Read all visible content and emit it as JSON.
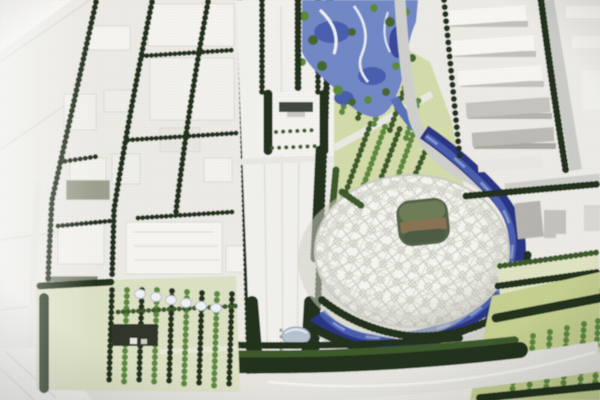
{
  "scene": {
    "kind": "photograph",
    "subject": "Aerial photo of an architectural scale model of an Olympic park district",
    "notable_features": [
      "white lattice-shell oval stadium (bird's-nest style) with rounded roof opening showing green field and brown stands",
      "dark blue crescent canal wrapping the stadium's south and east sides",
      "winding light-blue river through a wooded water park at top center",
      "broad white north-south central axis boulevard lined with dark tree rows and a small dark-roofed gate",
      "grid of white city blocks with tree-lined streets on the left half",
      "rows of white slab buildings with a diagonal road in the upper right",
      "dense dark evergreen grove with small white dome structures at lower left",
      "yellow-green lawns with regular tree rows along the bottom and lower right",
      "grey ring road sweeping from top center around the stadium"
    ]
  },
  "palette": {
    "ground_base": "#ebeae5",
    "road_light": "#f1f0ec",
    "road_grey": "#cfd0cc",
    "block_white": "#f6f5f1",
    "block_side": "#cfcec8",
    "block_grey": "#b4b3ad",
    "block_olive": "#9ca08d",
    "tree_dark": "#24331b",
    "tree_mid": "#3d5a2a",
    "tree_bright": "#5c8a3c",
    "park_ground": "#d2dba9",
    "lawn_yellow_green": "#c4cf90",
    "grove_ground": "#dce1c4",
    "water_light": "#7288c6",
    "water_mid": "#4a5fae",
    "water_dark": "#2c3684",
    "stadium_shell": "#f5f5f0",
    "stadium_lattice": "#c8c8c0",
    "stadium_field": "#6e7d57",
    "stadium_stand": "#8a7352",
    "gate_roof": "#40463f",
    "dome_blue_grey": "#b7c2cf"
  },
  "regions": {
    "west": "low-contrast white parcels and blocks with tilted tree-lined streets",
    "center": "central axis boulevard running full height",
    "top_center": "water park with winding river and bright tree clusters",
    "center_right": "lattice stadium ringed by canal, trees and grey road",
    "top_right": "slab housing rows beside a diagonal tree-lined road",
    "bottom": "dense dark tree band over a curving light road",
    "bottom_left": "formal grove with white dome structures and a dark pavilion",
    "bottom_right": "lawn with evenly spaced bright tree columns"
  }
}
